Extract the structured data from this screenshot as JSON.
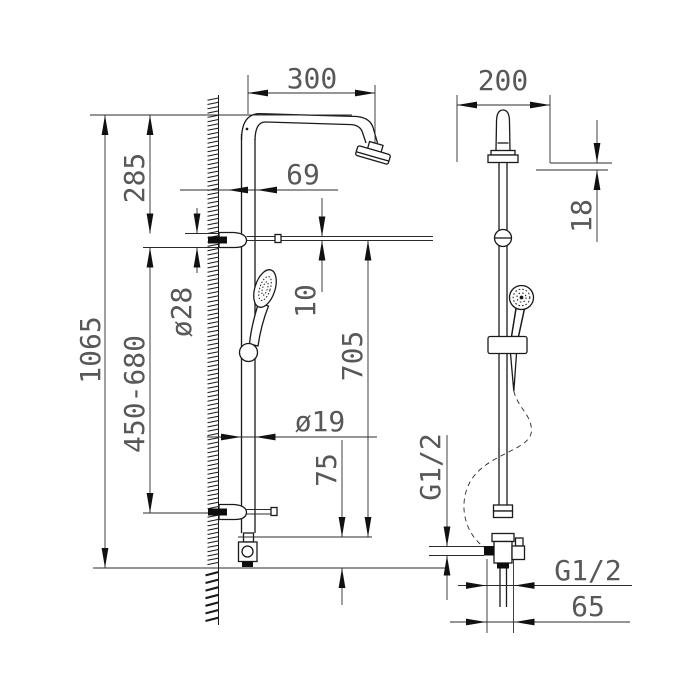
{
  "drawing": {
    "type": "technical-dimension-drawing",
    "subject": "shower column with overhead arm and hand shower, front and side views",
    "line_color": "#1a1a1a",
    "dim_text_color": "#585858",
    "background": "#ffffff",
    "dims": {
      "arm_projection": "300",
      "upper_offset": "285",
      "wall_to_pipe": "69",
      "escutcheon_dia": "ø28",
      "bracket_gap": "10",
      "overall_height": "1065",
      "rail_range": "450-680",
      "mid_height": "705",
      "pipe_dia": "ø19",
      "outlet_height": "75",
      "side_width": "200",
      "head_thickness": "18",
      "inlet_thread": "G1/2",
      "outlet_thread": "G1/2",
      "outlet_offset": "65"
    }
  }
}
